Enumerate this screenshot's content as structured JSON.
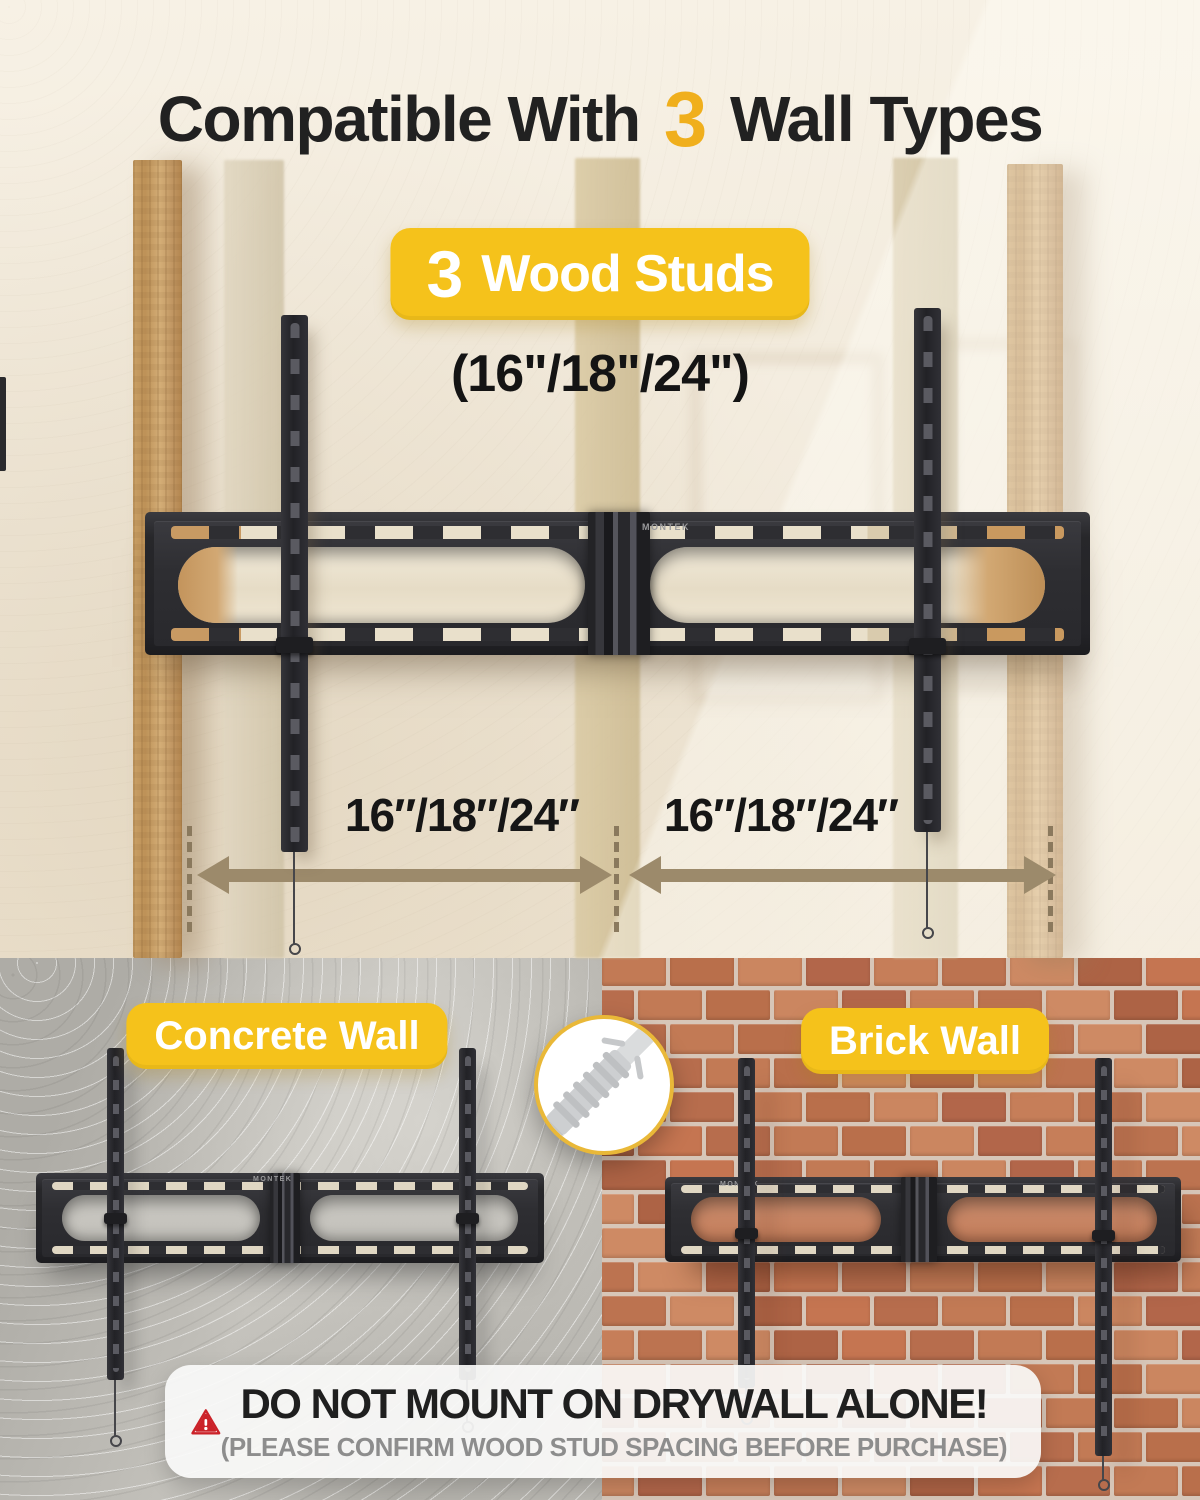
{
  "brand": "MONTEK",
  "header": {
    "title_prefix": "Compatible With",
    "title_number": "3",
    "title_suffix": "Wall Types"
  },
  "wood": {
    "badge_number": "3",
    "badge_label": "Wood Studs",
    "sizes_caption": "(16\"/18\"/24\")",
    "left_spacing": "16″/18″/24″",
    "right_spacing": "16″/18″/24″"
  },
  "concrete": {
    "badge_label": "Concrete Wall"
  },
  "brick": {
    "badge_label": "Brick Wall"
  },
  "warning": {
    "title": "DO NOT MOUNT ON DRYWALL ALONE!",
    "subtitle": "(PLEASE CONFIRM WOOD STUD SPACING BEFORE PURCHASE)"
  },
  "colors": {
    "accent_yellow": "#F5C21B",
    "title_number_yellow": "#F0AF1C",
    "arrow_brown": "#9C8A6B",
    "warning_red": "#CB2229"
  }
}
